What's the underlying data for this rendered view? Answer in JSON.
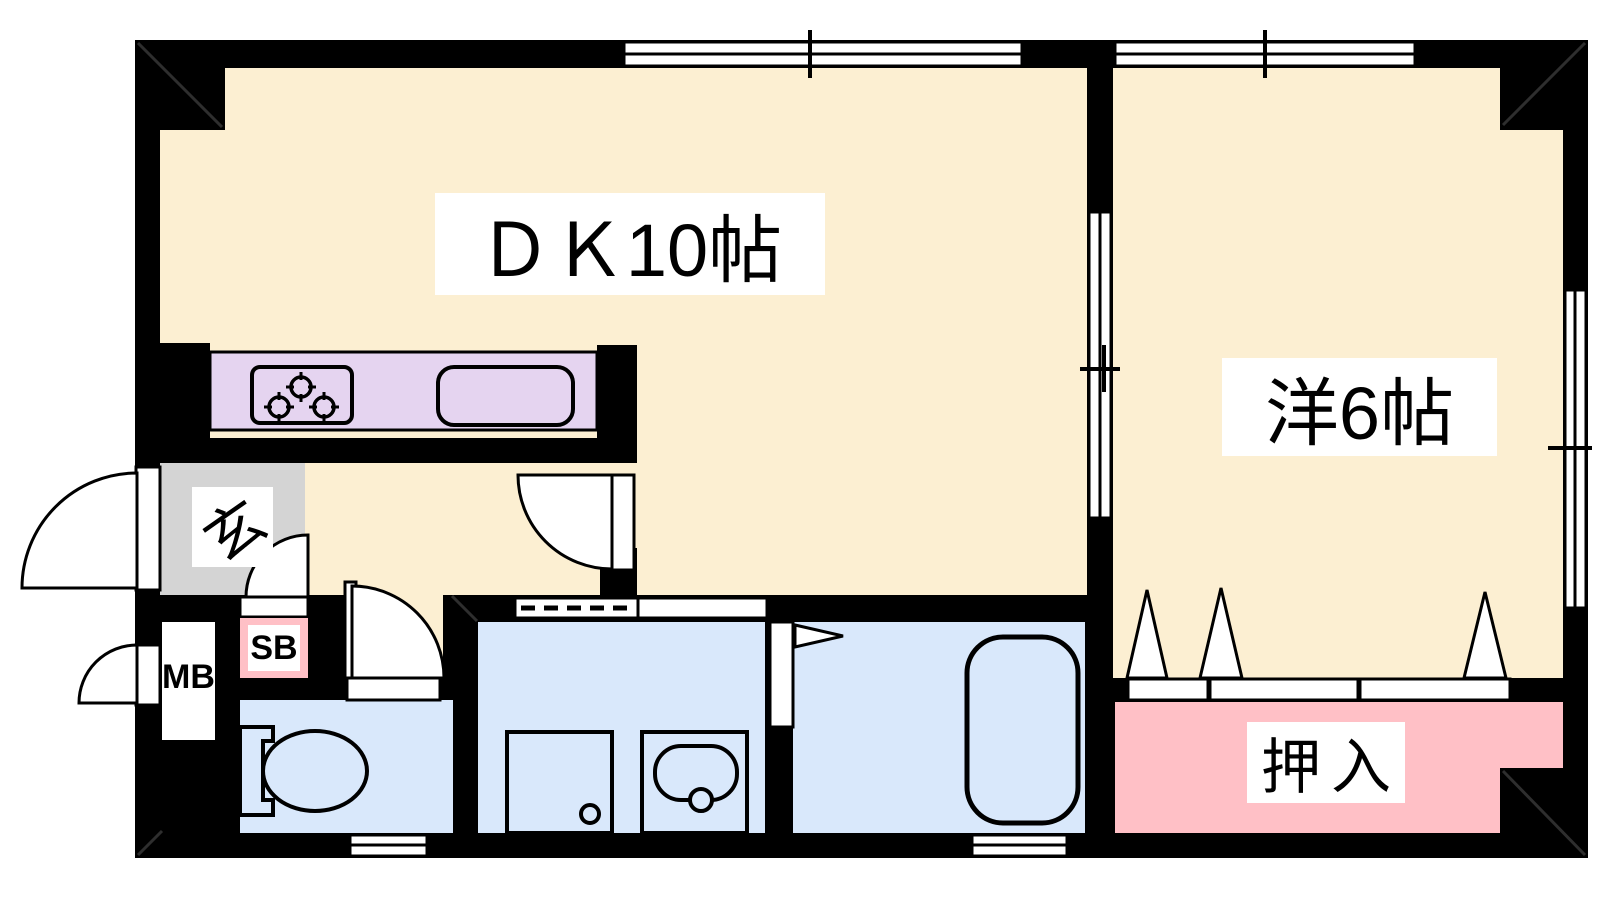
{
  "title": "apartment-floor-plan",
  "colors": {
    "wall": "#000000",
    "room": "#FCEFD2",
    "wet": "#D9E8FB",
    "closet_pink": "#FFC0C6",
    "counter": "#E5D4F0",
    "entrance_gray": "#D4D4D4"
  },
  "rooms": {
    "dining_kitchen": {
      "label": "ＤＫ10帖"
    },
    "western_room": {
      "label": "洋6帖"
    },
    "entrance": {
      "label": "玄"
    },
    "closet": {
      "label": "押入"
    },
    "meter_box": {
      "label": "MB"
    },
    "shoe_box": {
      "label": "SB"
    }
  }
}
